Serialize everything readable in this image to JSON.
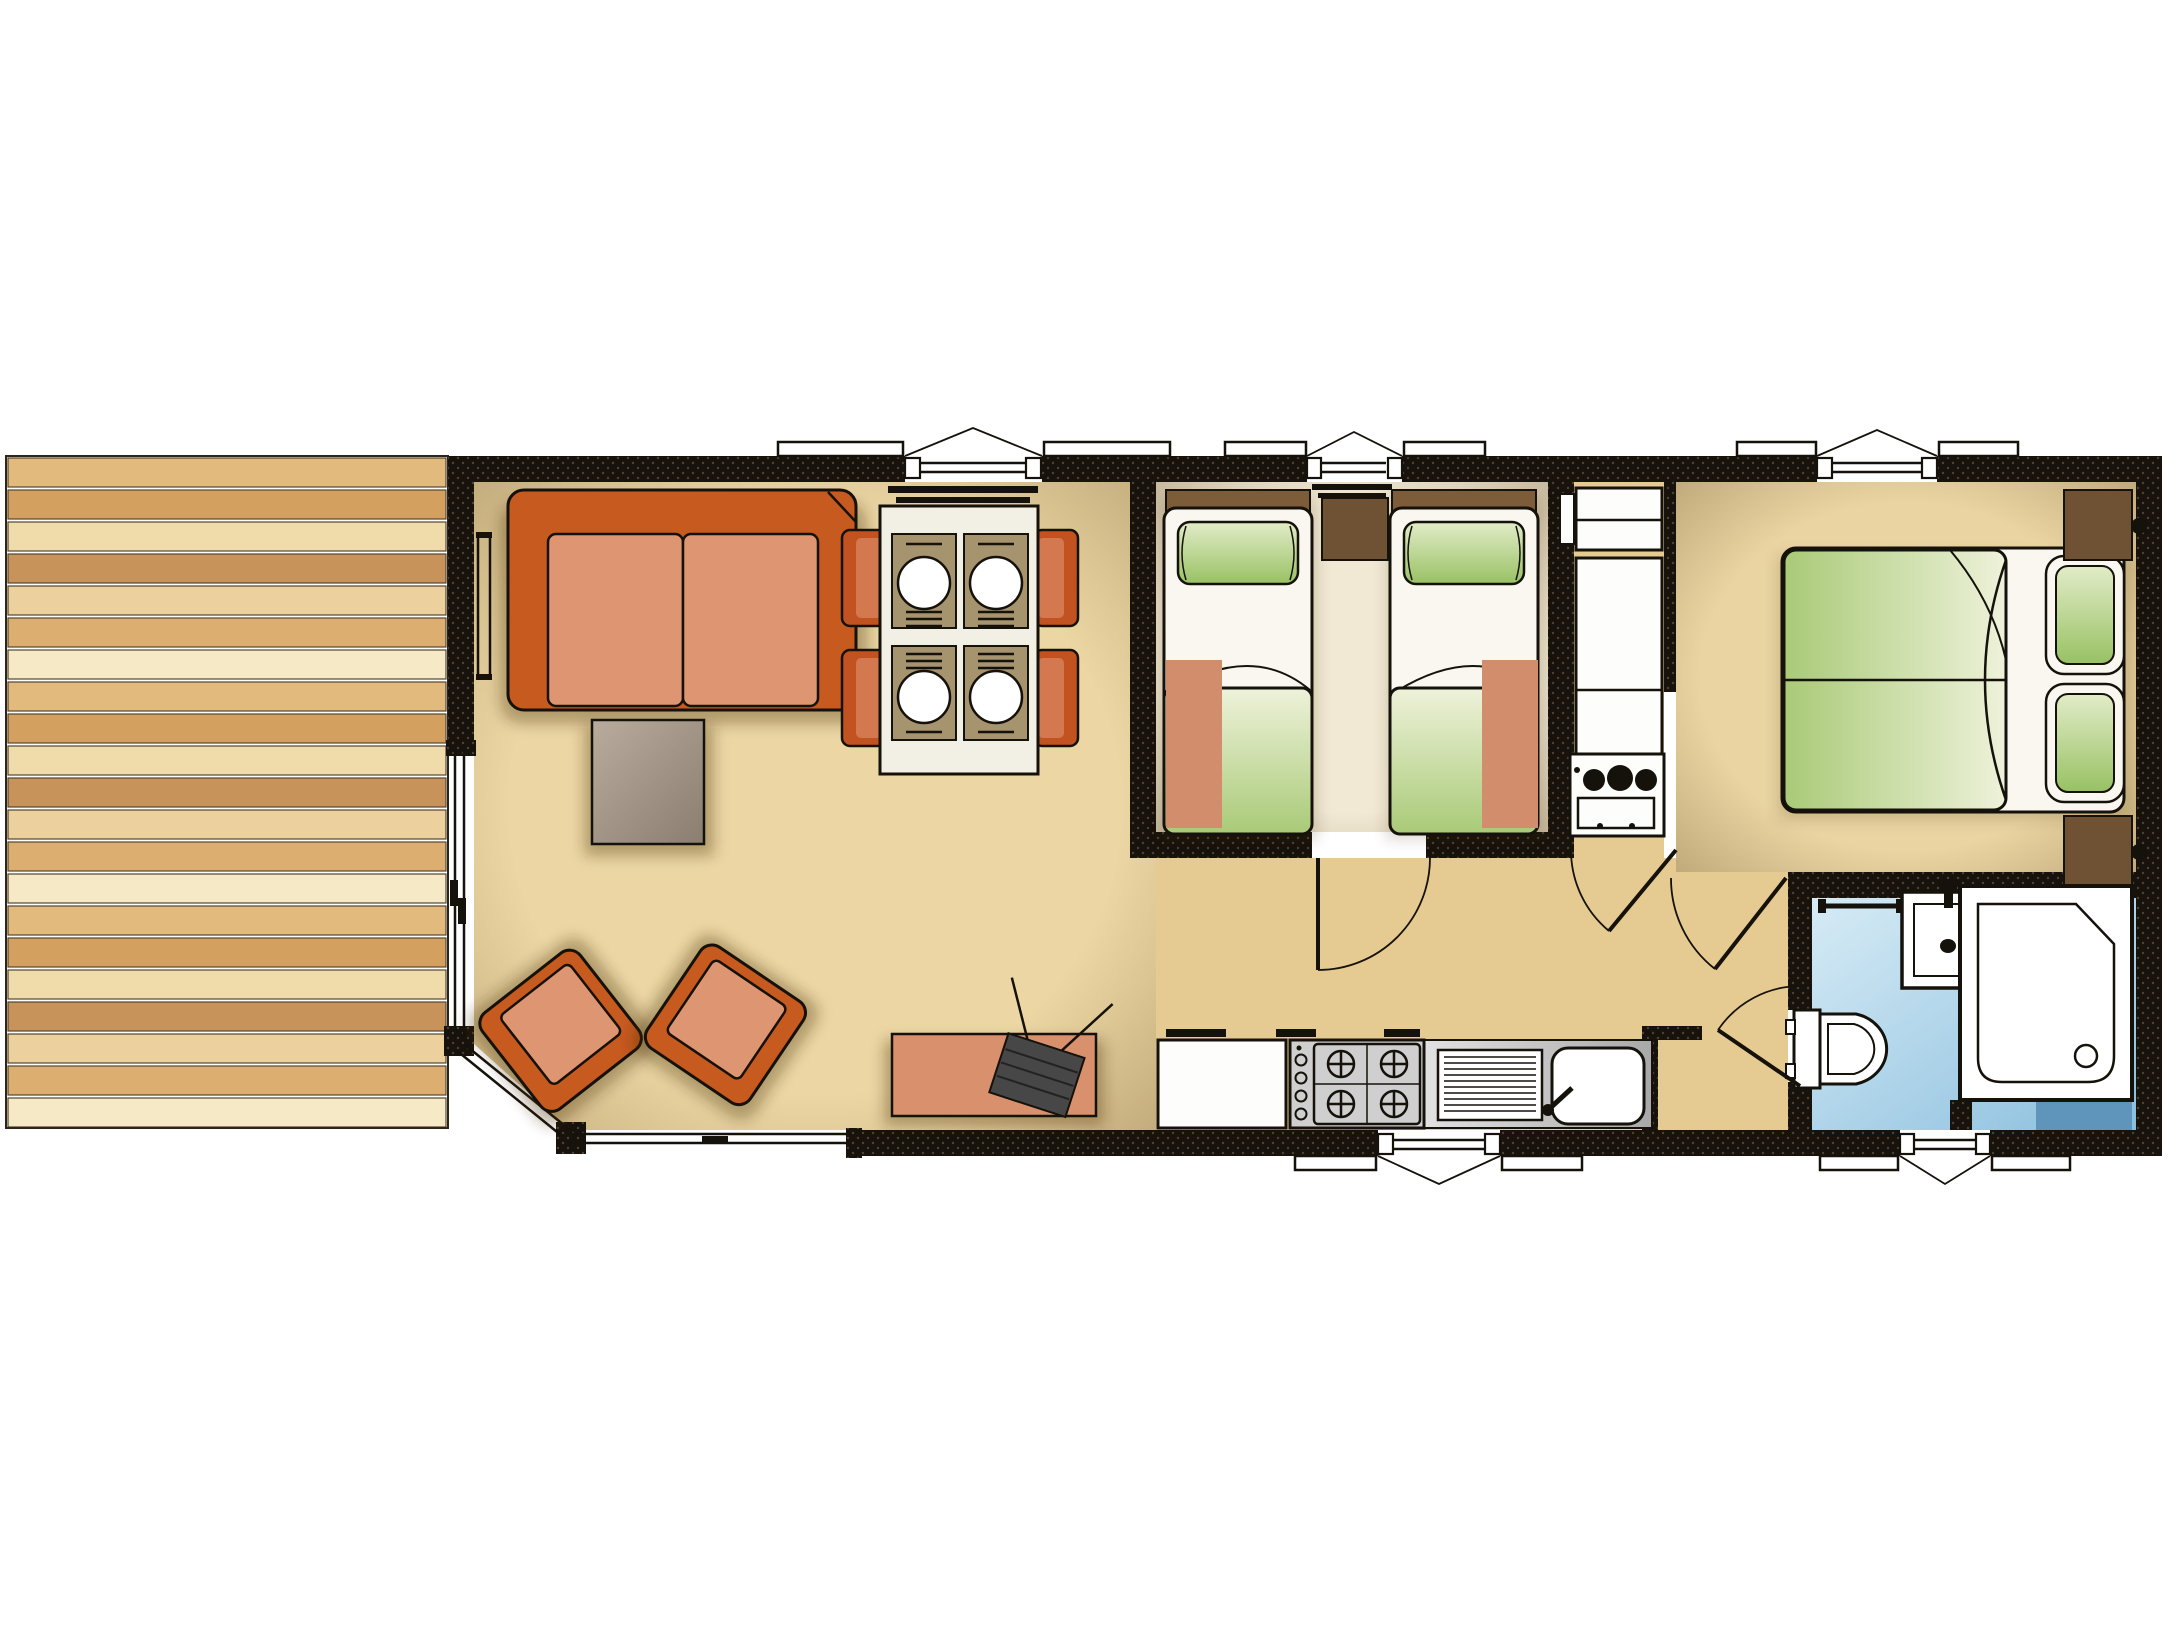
{
  "meta": {
    "type": "floor-plan",
    "description": "Top-down architectural floor plan of a holiday lodge / mobile home with front decking",
    "canvas": {
      "width": 2178,
      "height": 1634
    }
  },
  "colors": {
    "wall": "#17120c",
    "wall_speckle": "#4e4332",
    "line": "#15110b",
    "deck_line": "#55452e",
    "white": "#ffffff",
    "floor_living": "#ecd7a4",
    "floor_hall": "#e5cb92",
    "floor_twin": "#f1e9d4",
    "floor_double": "#e9d4a2",
    "bath_light": "#d6ebf5",
    "bath_deep": "#8abede",
    "bath_mat": "#6095bb",
    "sofa_frame": "#c75a1f",
    "sofa_cushion": "#dd9671",
    "dining_chair": "#c2521f",
    "dining_chair_light": "#d3784f",
    "dining_table": "#f2efe4",
    "placemat": "#a6946f",
    "coffee_light": "#b9ac9f",
    "coffee_dark": "#8b7d6f",
    "tv_unit": "#d8916c",
    "tv_screen": "#474747",
    "mattress": "#f9f7f0",
    "duvet": "#a9ca77",
    "duvet_light": "#eef2da",
    "pillow": "#98c163",
    "pillow_light": "#e2ecc8",
    "headboard": "#7d5c39",
    "bedside": "#6e5233",
    "bench": "#d28e6c",
    "unit_white": "#fdfdfb",
    "hob_panel": "#cfcfcf",
    "counter_light": "#e2e2e2",
    "counter_dark": "#a9a9a9"
  },
  "deck": {
    "plank_count": 21,
    "plank_colors": [
      "#e2ba7e",
      "#d3a05f",
      "#f0dcab",
      "#c8935a",
      "#ecd09d",
      "#dcae6f",
      "#f6e9c6"
    ]
  },
  "rooms": [
    {
      "id": "deck",
      "label": "timber decking"
    },
    {
      "id": "living-dining",
      "label": "open plan lounge / diner"
    },
    {
      "id": "kitchen",
      "label": "kitchen"
    },
    {
      "id": "twin-bedroom",
      "label": "twin bedroom"
    },
    {
      "id": "double-bedroom",
      "label": "double bedroom"
    },
    {
      "id": "bathroom",
      "label": "bathroom"
    },
    {
      "id": "hallway",
      "label": "hallway"
    }
  ],
  "furniture": {
    "living": [
      "two-seat sofa",
      "coffee table",
      "dining table with four chairs and four place settings",
      "two armchairs",
      "tv unit with television"
    ],
    "kitchen": [
      "base unit",
      "four-burner gas hob",
      "drainer",
      "sink with tap",
      "worktop",
      "tall larder unit",
      "wall cabinet",
      "boiler / oven unit"
    ],
    "twin_bedroom": [
      "single bed x2 with green duvets",
      "bedside cabinet",
      "two ottoman benches"
    ],
    "double_bedroom": [
      "double bed with green duvet and two pillows",
      "two bedside cabinets with lamps"
    ],
    "bathroom": [
      "wash basin",
      "toilet",
      "bath tub",
      "towel rail",
      "bath mat"
    ]
  },
  "openings": {
    "windows": [
      "dining window (top)",
      "twin bedroom window (top)",
      "double bedroom window (top)",
      "kitchen window (bottom)",
      "bathroom window (bottom)",
      "lounge front glazing (bottom-left)",
      "patio sliding door (left)",
      "chamfered corner glazing"
    ],
    "doors": [
      "twin bedroom door",
      "hallway door",
      "bedroom lobby door",
      "bathroom door"
    ]
  }
}
